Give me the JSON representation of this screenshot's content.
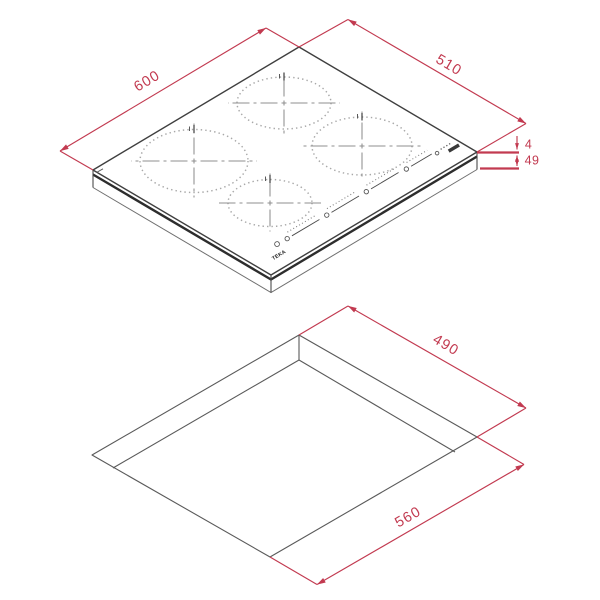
{
  "diagram": {
    "accent_color": "#c23a50",
    "ink_color": "#3f3f3f",
    "brand_label": "TEKA",
    "hob_view": {
      "width": "600",
      "depth": "510",
      "height_top": "4",
      "height_bottom": "49"
    },
    "cutout_view": {
      "depth": "490",
      "width": "560"
    }
  }
}
